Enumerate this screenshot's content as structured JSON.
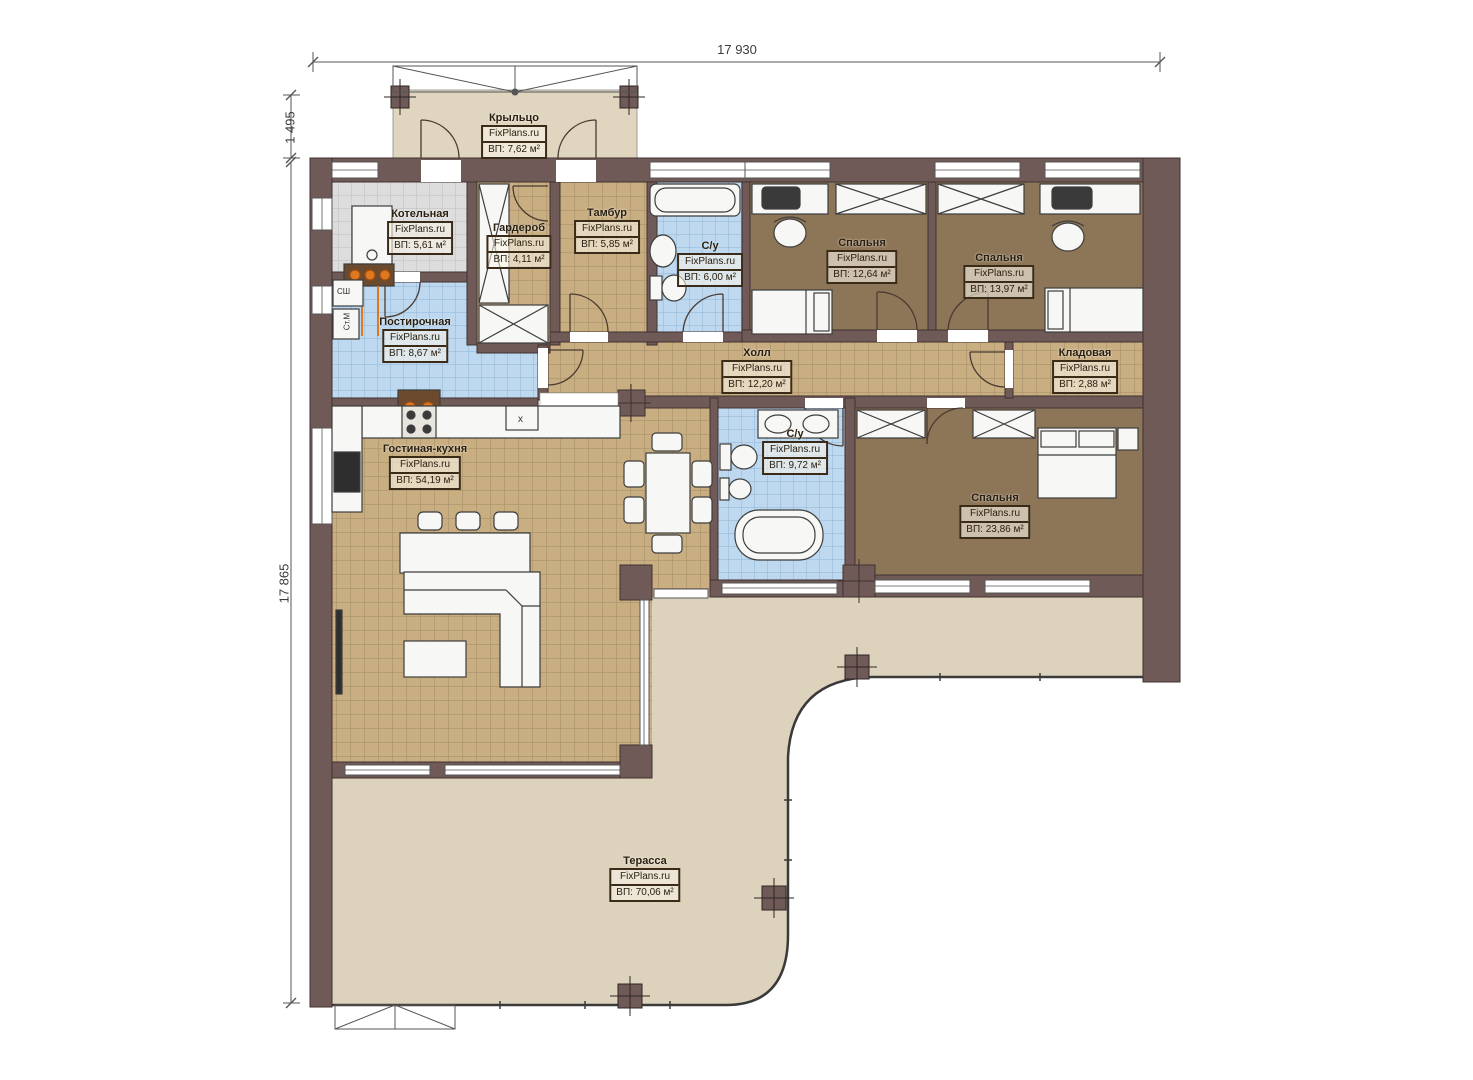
{
  "plan": {
    "brand": "FixPlans.ru",
    "dimensions": {
      "width_total": "17 930",
      "porch_depth": "1 495",
      "height_total": "17 865"
    },
    "rooms": [
      {
        "id": "porch",
        "name": "Крыльцо",
        "brand": "FixPlans.ru",
        "area": "ВП: 7,62 м²"
      },
      {
        "id": "boiler-room",
        "name": "Котельная",
        "brand": "FixPlans.ru",
        "area": "ВП: 5,61 м²"
      },
      {
        "id": "wardrobe",
        "name": "Гардероб",
        "brand": "FixPlans.ru",
        "area": "ВП: 4,11 м²"
      },
      {
        "id": "vestibule",
        "name": "Тамбур",
        "brand": "FixPlans.ru",
        "area": "ВП: 5,85 м²"
      },
      {
        "id": "bathroom-1",
        "name": "С/у",
        "brand": "FixPlans.ru",
        "area": "ВП: 6,00 м²"
      },
      {
        "id": "bedroom-1",
        "name": "Спальня",
        "brand": "FixPlans.ru",
        "area": "ВП: 12,64 м²"
      },
      {
        "id": "bedroom-2",
        "name": "Спальня",
        "brand": "FixPlans.ru",
        "area": "ВП: 13,97 м²"
      },
      {
        "id": "laundry",
        "name": "Постирочная",
        "brand": "FixPlans.ru",
        "area": "ВП: 8,67 м²"
      },
      {
        "id": "hall",
        "name": "Холл",
        "brand": "FixPlans.ru",
        "area": "ВП: 12,20 м²"
      },
      {
        "id": "storage",
        "name": "Кладовая",
        "brand": "FixPlans.ru",
        "area": "ВП: 2,88 м²"
      },
      {
        "id": "living-kitchen",
        "name": "Гостиная-кухня",
        "brand": "FixPlans.ru",
        "area": "ВП: 54,19 м²"
      },
      {
        "id": "bathroom-2",
        "name": "С/у",
        "brand": "FixPlans.ru",
        "area": "ВП: 9,72 м²"
      },
      {
        "id": "bedroom-3",
        "name": "Спальня",
        "brand": "FixPlans.ru",
        "area": "ВП: 23,86 м²"
      },
      {
        "id": "terrace",
        "name": "Терасса",
        "brand": "FixPlans.ru",
        "area": "ВП: 70,06 м²"
      }
    ],
    "appliances": {
      "drying_cabinet": "СШ",
      "washing_machine": "Ст.М",
      "kitchen_mark": "x"
    },
    "colors": {
      "wall": "#6f5a57",
      "tile_tan": "#c9ae82",
      "tile_blue": "#bdd8ef",
      "tile_gray": "#dddddd",
      "floor_brown": "#8d7557",
      "terrace": "#ddd2bc",
      "porch": "#e0d5bf",
      "pipes_orange": "#e07820"
    }
  }
}
